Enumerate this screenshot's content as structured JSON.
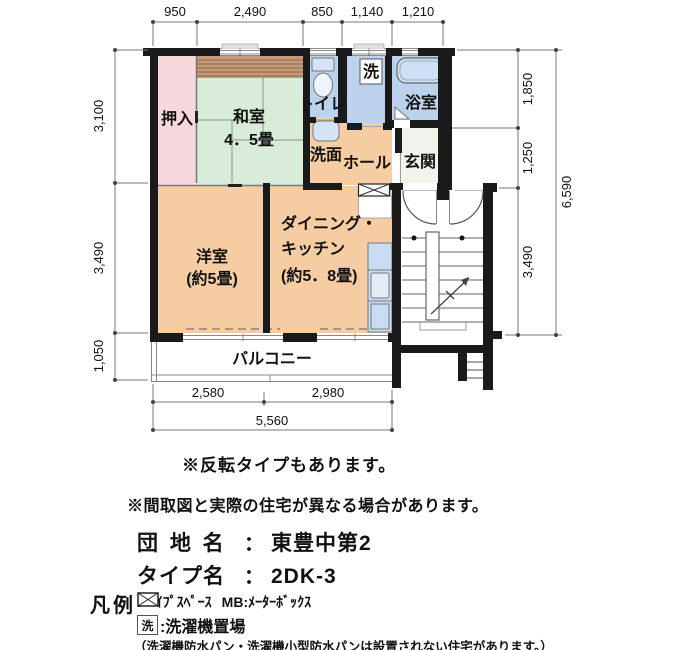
{
  "plan": {
    "rooms": {
      "oshiire": "押入",
      "washitsu": "和室",
      "washitsu_size": "4．5畳",
      "toilet": "トイレ",
      "laundry_mark": "洗",
      "bath": "浴室",
      "washstand": "洗面",
      "hall": "ホール",
      "entrance": "玄関",
      "western": "洋室",
      "western_size": "(約5畳)",
      "dk1": "ダイニング・",
      "dk2": "キッチン",
      "dk_size": "(約5．8畳)",
      "balcony": "バルコニー"
    },
    "dims": {
      "top": [
        "950",
        "2,490",
        "850",
        "1,140",
        "1,210"
      ],
      "left": [
        "3,100",
        "3,490",
        "1,050"
      ],
      "right": [
        "1,850",
        "1,250",
        "3,490"
      ],
      "right_total": "6,590",
      "bottom": [
        "2,580",
        "2,980"
      ],
      "bottom_total": "5,560"
    }
  },
  "notes": {
    "reverse": "※反転タイプもあります。",
    "differ": "※間取図と実際の住宅が異なる場合があります。"
  },
  "info": {
    "estate_label": "団 地 名",
    "colon": "：",
    "estate_value": "東豊中第2",
    "type_label": "タイプ名",
    "type_value": "2DK-3"
  },
  "legend": {
    "title": "凡例",
    "ps_text": ":ﾊﾟｲﾌﾟｽﾍﾟｰｽ",
    "mb_text": "MB:ﾒｰﾀｰﾎﾞｯｸｽ",
    "laundry_symbol": "洗",
    "laundry_text": ":洗濯機置場",
    "note": "（洗濯機防水パン・洗濯機小型防水パンは設置されない住宅があります。）"
  },
  "colors": {
    "wall": "#1a1a1a",
    "tatami_green": "#d9ecd9",
    "closet_pink": "#f7d9dd",
    "wood_brown": "#c49a78",
    "room_orange": "#f6cda2",
    "water_blue": "#bcd2ec",
    "fixture_blue": "#d5e3f6",
    "entrance_gray": "#f3f3ee"
  }
}
